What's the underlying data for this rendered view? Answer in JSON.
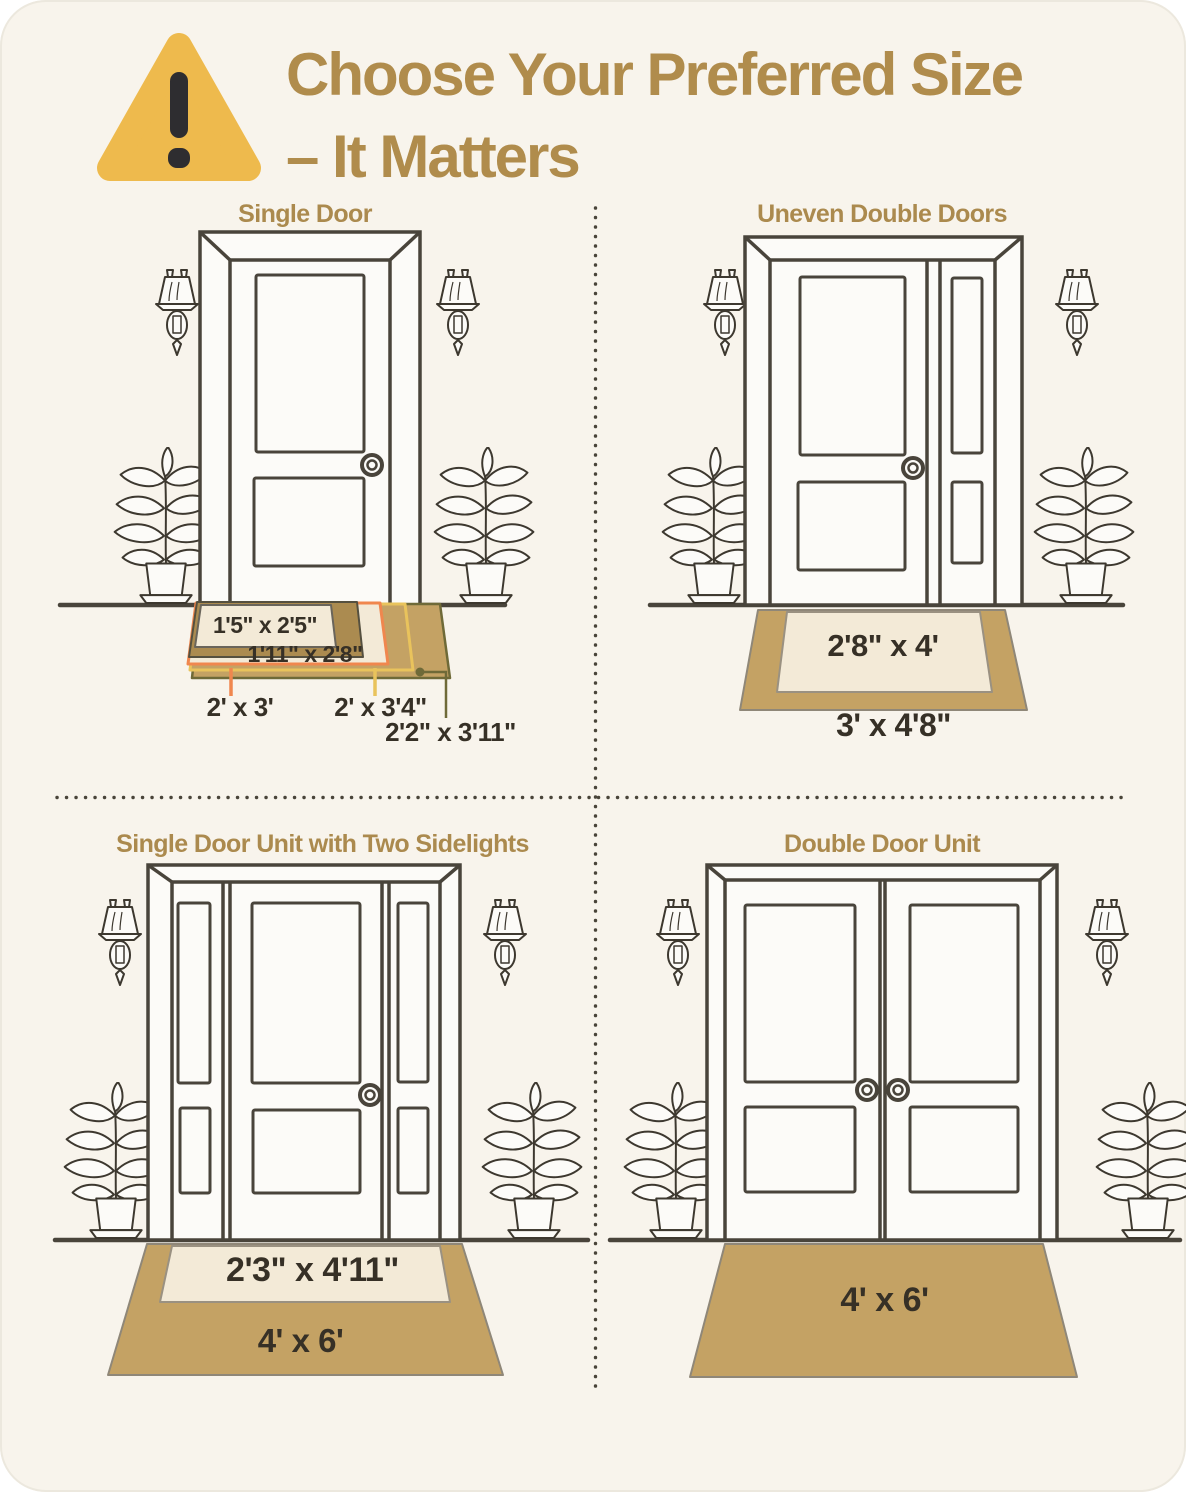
{
  "header": {
    "title_line1": "Choose Your Preferred Size",
    "title_line2": "– It Matters",
    "warning_icon": "warning-triangle"
  },
  "quadrants": {
    "single_door": {
      "label": "Single Door",
      "mats": {
        "size_1": "1'5\" x 2'5\"",
        "size_2": "1'11\" x 2'8\"",
        "size_3": "2' x 3'",
        "size_4": "2' x 3'4\"",
        "size_5": "2'2\" x 3'11\""
      }
    },
    "uneven_double_doors": {
      "label": "Uneven Double Doors",
      "mats": {
        "inner": "2'8\" x 4'",
        "outer": "3' x 4'8\""
      }
    },
    "single_door_sidelights": {
      "label": "Single Door Unit with Two Sidelights",
      "mats": {
        "inner": "2'3\" x 4'11\"",
        "outer": "4' x 6'"
      }
    },
    "double_door": {
      "label": "Double Door Unit",
      "mats": {
        "single": "4' x 6'"
      }
    }
  },
  "colors": {
    "background": "#f8f4ec",
    "title_gold": "#b08c4c",
    "label_gold": "#ab8a4e",
    "dark_text": "#363026",
    "line": "#49443b",
    "mat_tan": "#c4a264",
    "mat_dark_tan": "#ab8b50",
    "mat_cream": "#f3ead7",
    "accent_orange": "#f0874e",
    "accent_yellow": "#e9c35c",
    "accent_olive": "#6f6a38",
    "warning_amber": "#eeba4d"
  }
}
